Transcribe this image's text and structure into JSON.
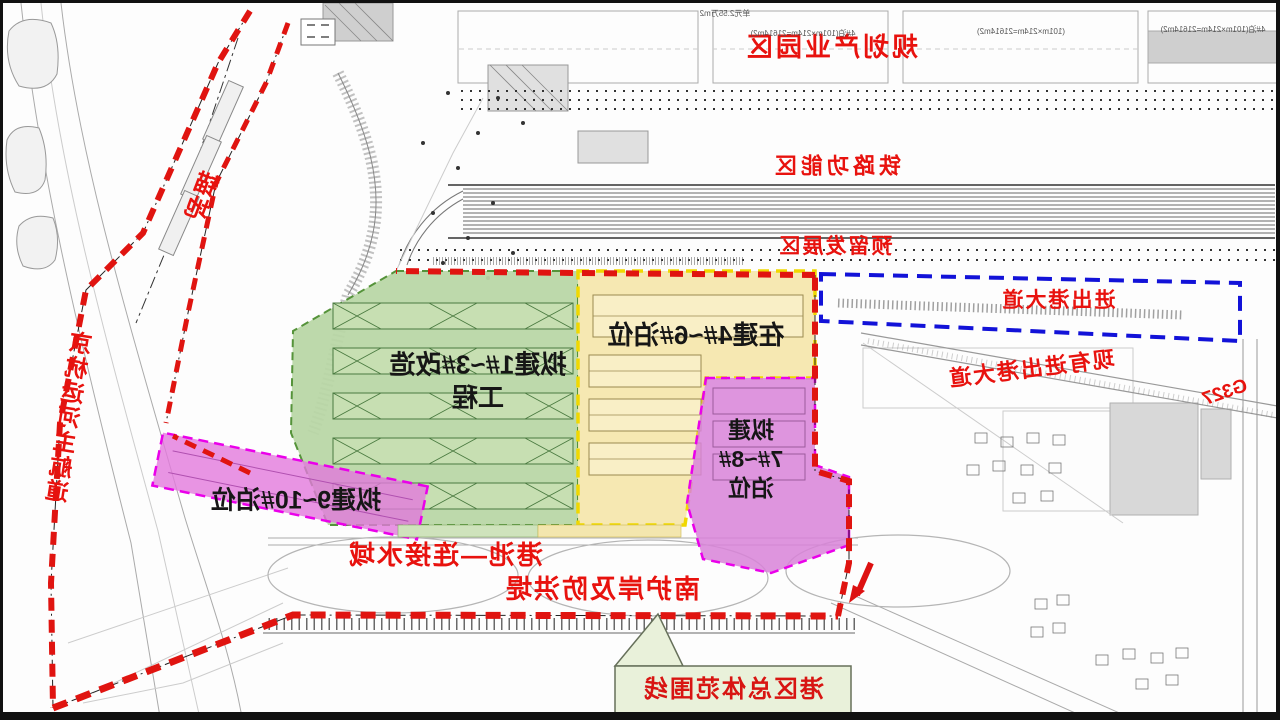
{
  "meta": {
    "orientation": "horizontally-mirrored site plan",
    "drawing_type": "port area master plan"
  },
  "colors": {
    "boundary_red": "#e01410",
    "avenue_blue": "#1212d8",
    "zone_green_fill": "#b9d7a6",
    "zone_yellow_fill": "#f6e7ae",
    "zone_yellow_border": "#f0d800",
    "zone_magenta_fill": "#d883d8",
    "zone_magenta_border": "#ea00ea",
    "callout_bg": "#e9f1da",
    "label_red": "#e8120e",
    "label_black": "#161616"
  },
  "labels": {
    "title": "规划产业园区",
    "railway_zone": "铁路功能区",
    "reserved_zone": "预留发展区",
    "port_avenue": "进出港大道",
    "existing_avenue": "现有进出港大道",
    "g327": "G327",
    "anchorage": "锚地",
    "canal": "京杭运河主航道",
    "green_zone_line1": "拟建1#~3#改造",
    "green_zone_line2": "工程",
    "yellow_zone": "在建4#~6#泊位",
    "magenta_line1": "拟建",
    "magenta_line2": "7#~8#",
    "magenta_line3": "泊位",
    "west_berths": "拟建9~10#泊位",
    "basin": "港池—连接水域",
    "revetment": "南护岸及防洪堤",
    "boundary_callout": "港区总体范围线",
    "ann_unit": "单元2.55万m2",
    "ann_berth_a": "4#泊(101m×214m=21614m2)",
    "ann_berth_b": "(101m×214m=21614m2)",
    "ann_berth_c": "4#泊(101m×214m=21614m2)"
  }
}
